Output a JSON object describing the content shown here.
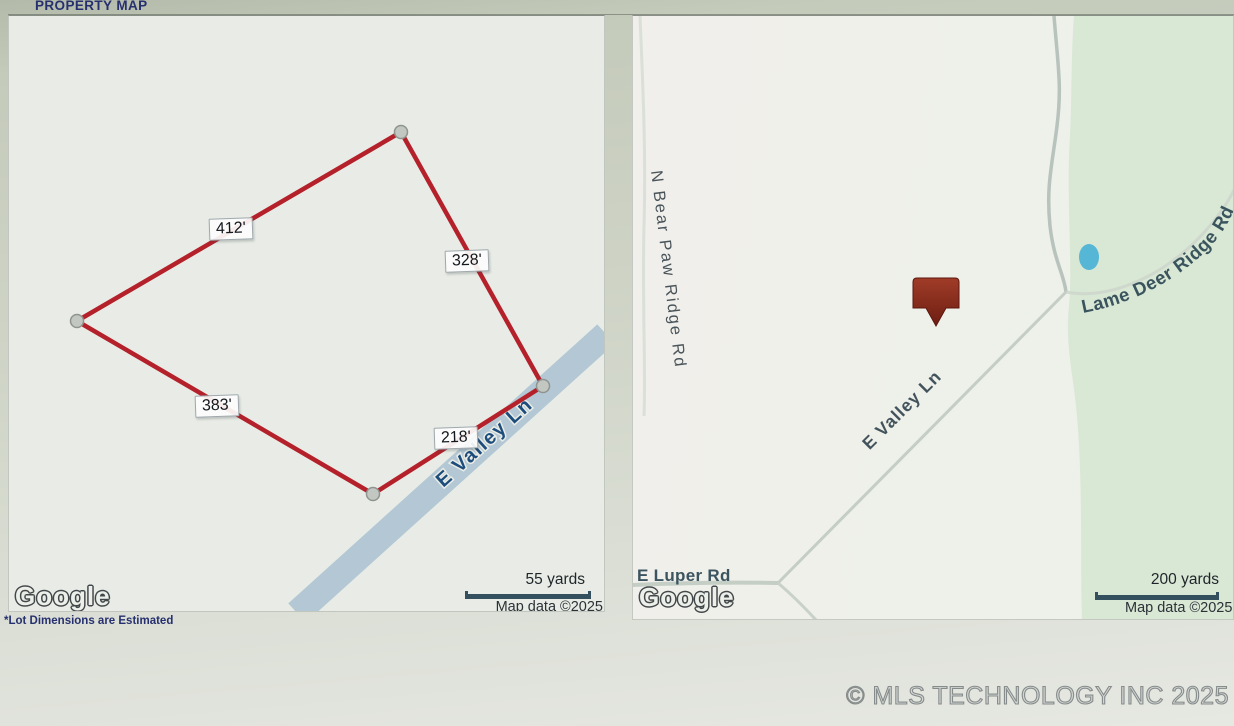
{
  "header": {
    "title": "PROPERTY MAP"
  },
  "footnote": "*Lot Dimensions are Estimated",
  "watermark": "© MLS TECHNOLOGY INC 2025",
  "left_map": {
    "provider": "Google",
    "road_label": "E Valley Ln",
    "dimensions": [
      {
        "label": "412'"
      },
      {
        "label": "328'"
      },
      {
        "label": "383'"
      },
      {
        "label": "218'"
      }
    ],
    "scale": {
      "distance": "55 yards",
      "attribution": "Map data ©2025"
    }
  },
  "right_map": {
    "provider": "Google",
    "roads": {
      "bear_paw": "N Bear Paw Ridge Rd",
      "lame_deer": "Lame Deer Ridge Rd",
      "valley": "E Valley Ln",
      "luper": "E Luper Rd"
    },
    "scale": {
      "distance": "200 yards",
      "attribution": "Map data ©2025"
    }
  },
  "colors": {
    "boundary_red": "#b4212b",
    "road_water_blue": "#b3c8d4",
    "green_area": "#d9e7d5",
    "pond_blue": "#56b6d6",
    "marker_red": "#7c2318",
    "navy_text": "#26306f"
  }
}
